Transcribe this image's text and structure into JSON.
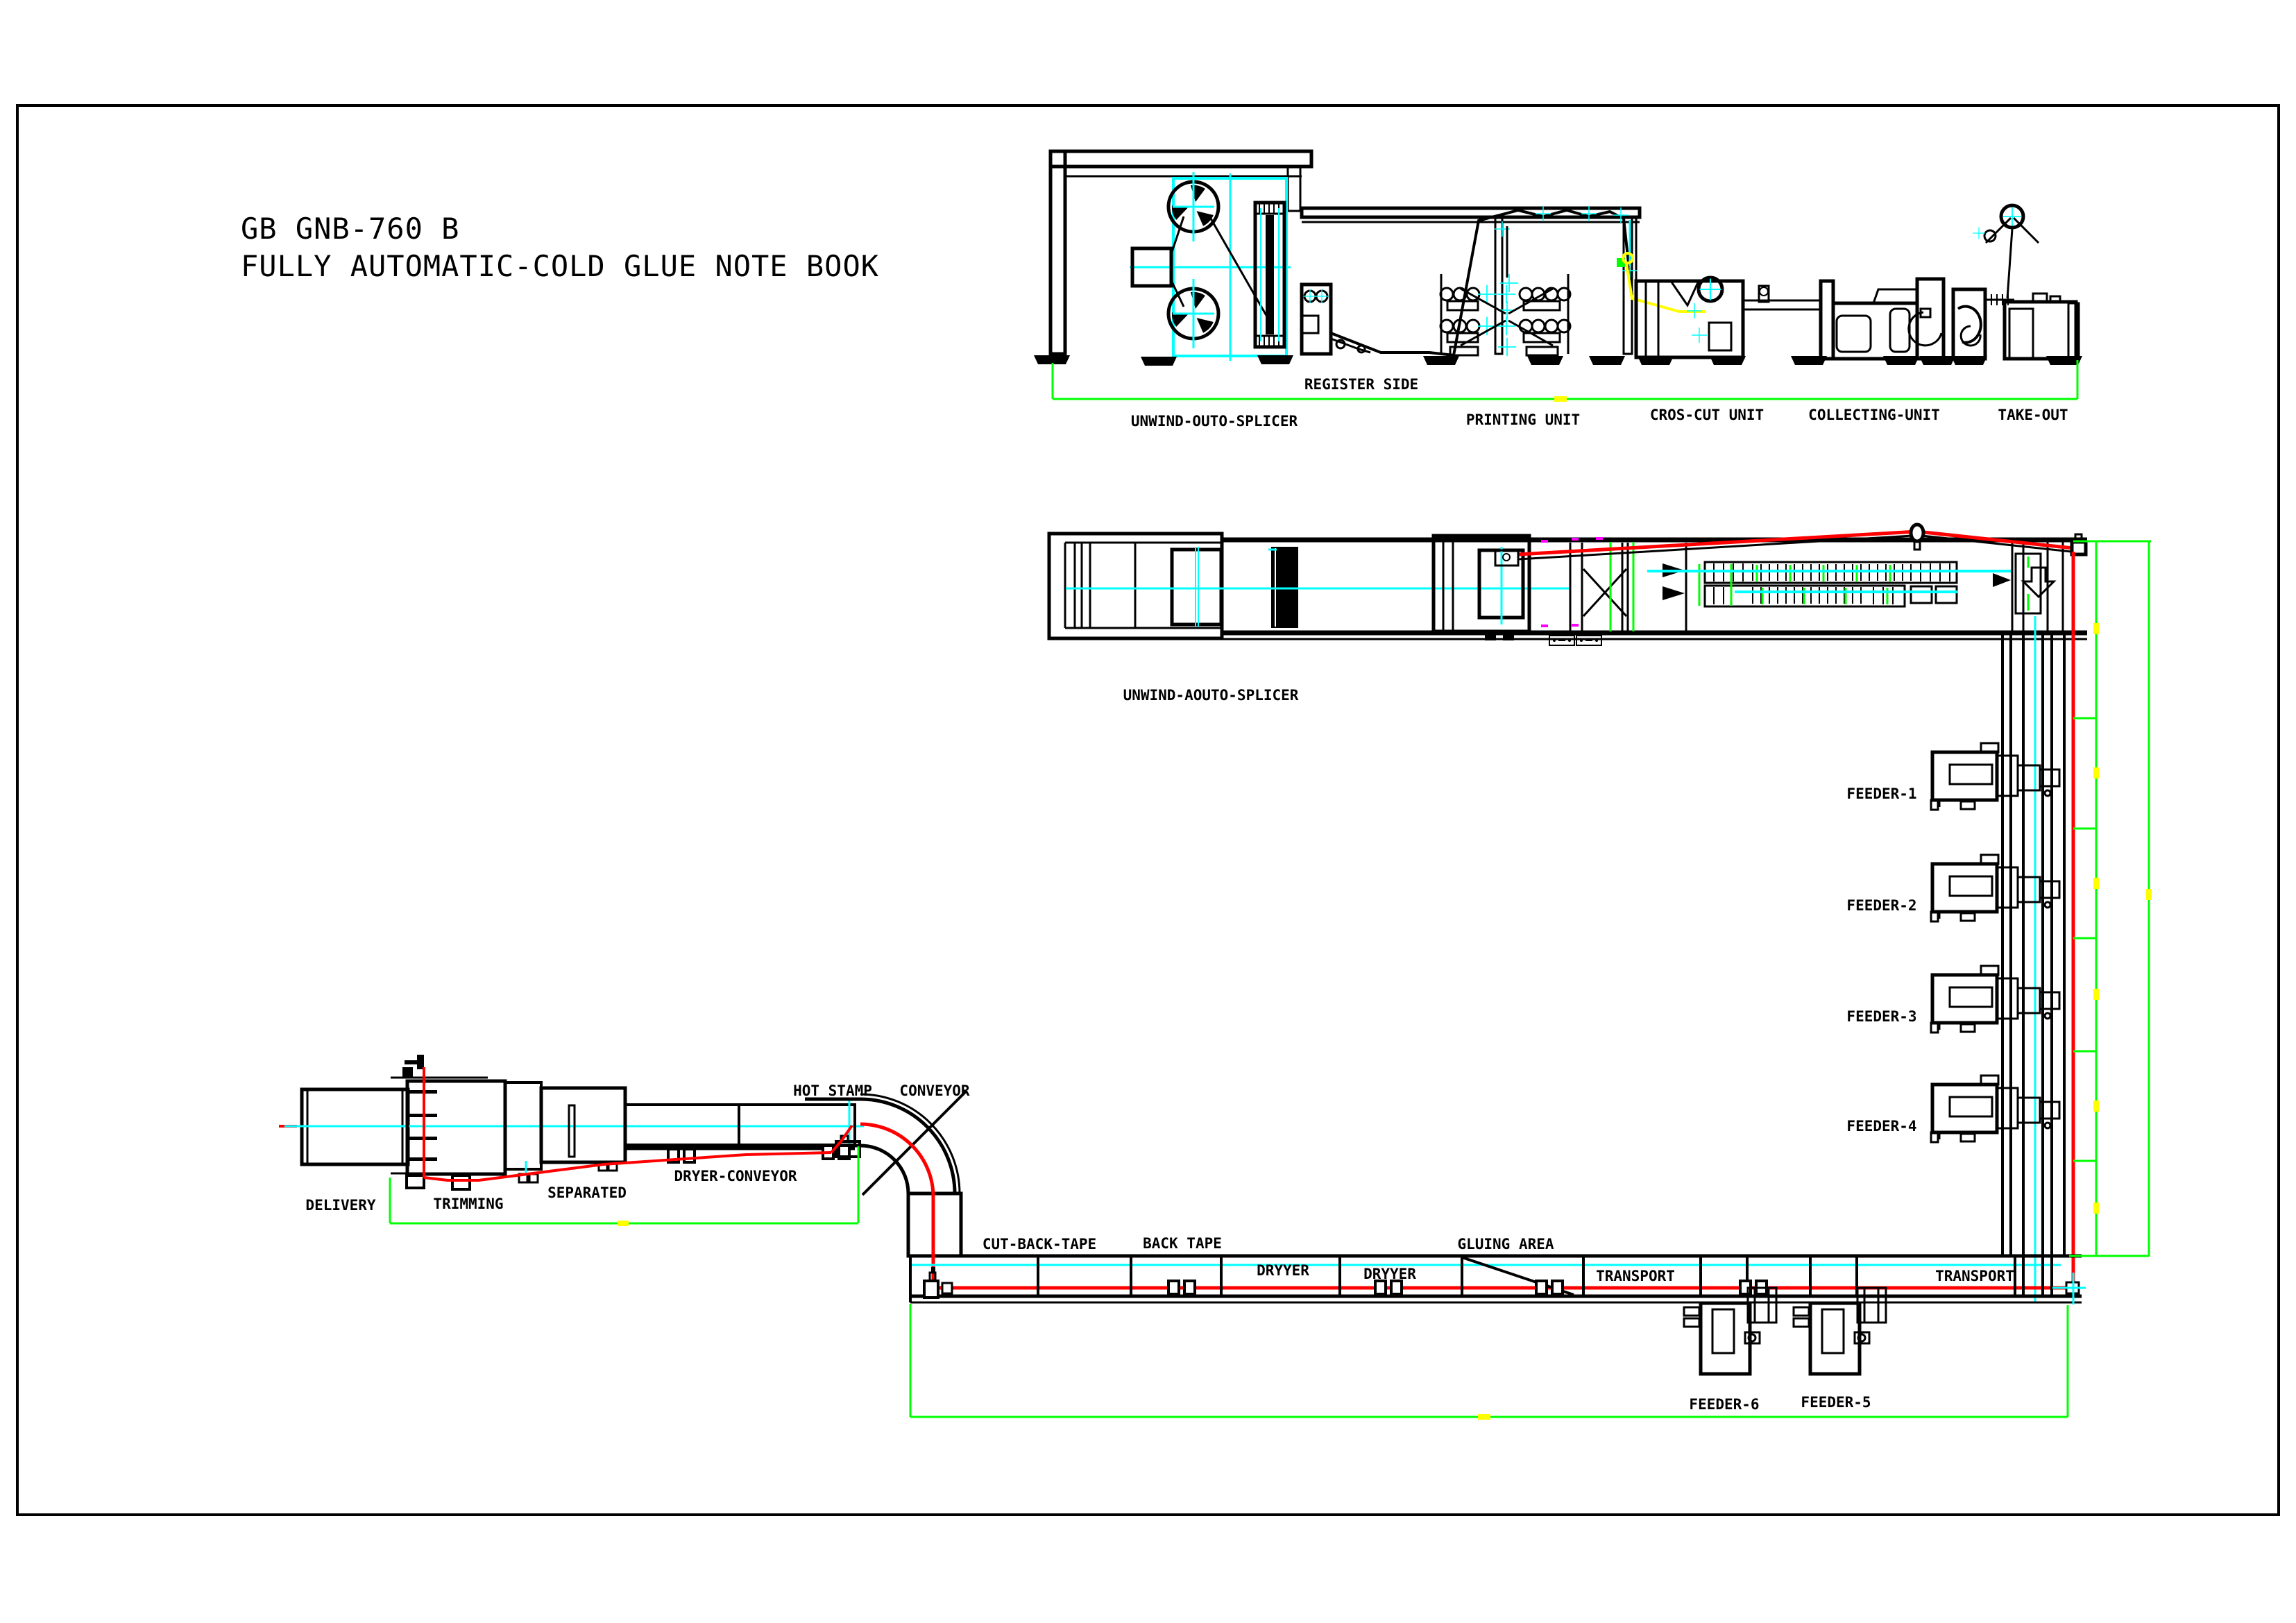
{
  "drawing": {
    "title_line1": "GB GNB-760 B",
    "title_line2": "FULLY AUTOMATIC-COLD GLUE NOTE BOOK"
  },
  "side_view": {
    "register_side": "REGISTER SIDE",
    "unwind": "UNWIND-OUTO-SPLICER",
    "printing": "PRINTING UNIT",
    "cros_cut": "CROS-CUT UNIT",
    "collecting": "COLLECTING-UNIT",
    "take_out": "TAKE-OUT"
  },
  "plan_view": {
    "unwind": "UNWIND-AOUTO-SPLICER",
    "feeders": [
      "FEEDER-1",
      "FEEDER-2",
      "FEEDER-3",
      "FEEDER-4"
    ]
  },
  "bottom_line": {
    "delivery": "DELIVERY",
    "trimming": "TRIMMING",
    "separated": "SEPARATED",
    "dryer_conveyor": "DRYER-CONVEYOR",
    "hot_stamp": "HOT STAMP",
    "conveyor": "CONVEYOR",
    "cut_back_tape": "CUT-BACK-TAPE",
    "back_tape": "BACK TAPE",
    "dryyer_1": "DRYYER",
    "dryyer_2": "DRYYER",
    "gluing_area": "GLUING AREA",
    "transport_1": "TRANSPORT",
    "transport_2": "TRANSPORT",
    "feeder_6": "FEEDER-6",
    "feeder_5": "FEEDER-5"
  },
  "colors": {
    "ink": "#000000",
    "background": "#ffffff",
    "centerline_cyan": "#00ffff",
    "web_path_red": "#ff0000",
    "dimension_green": "#00ff00",
    "tick_yellow": "#ffff00",
    "marker_magenta": "#ff00ff"
  }
}
